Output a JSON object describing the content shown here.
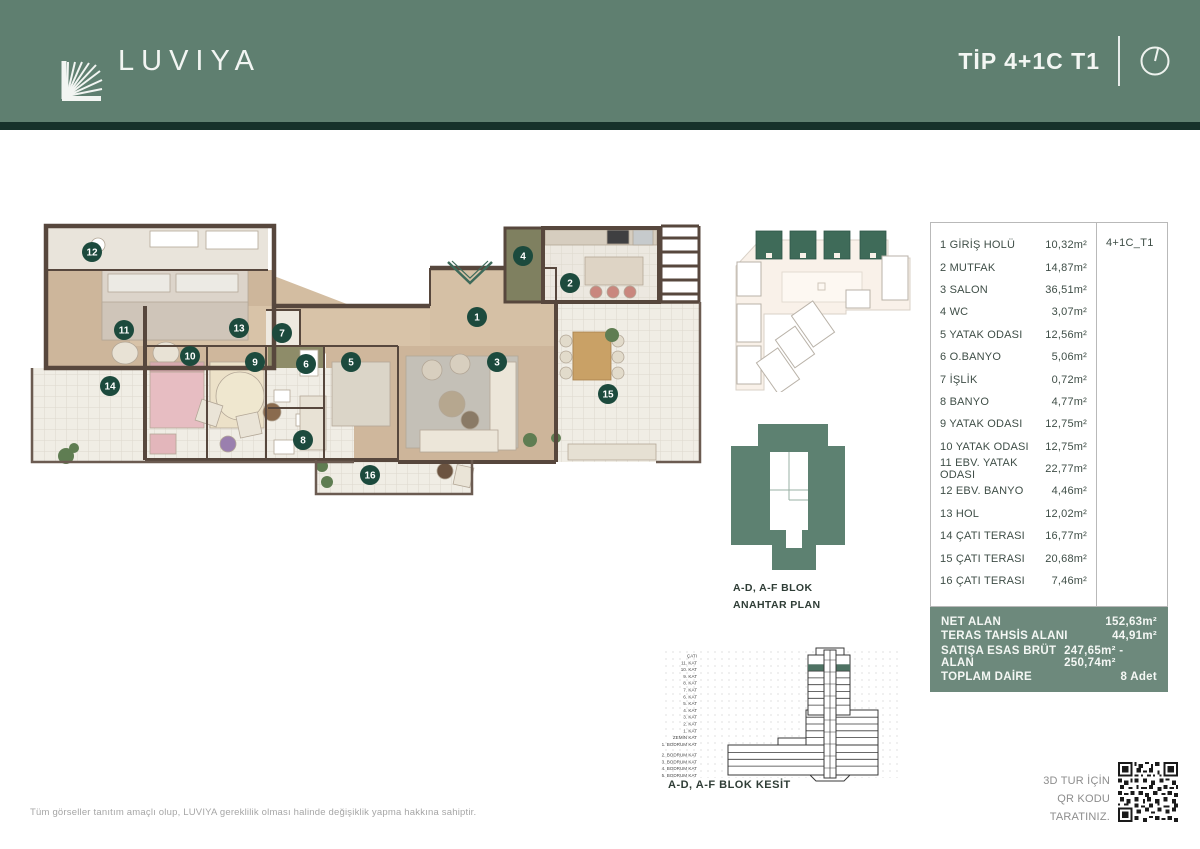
{
  "header": {
    "brand": "LUVIYA",
    "title": "TİP 4+1C T1",
    "compass_icon": "north-indicator-icon"
  },
  "floorplan": {
    "markers": [
      "1",
      "2",
      "3",
      "4",
      "5",
      "6",
      "7",
      "8",
      "9",
      "10",
      "11",
      "12",
      "13",
      "14",
      "15",
      "16"
    ],
    "entrance_arrow": "chevron-down"
  },
  "key_plan": {
    "line1": "A-D, A-F BLOK",
    "line2": "ANAHTAR PLAN"
  },
  "section": {
    "caption": "A-D, A-F BLOK KESİT",
    "highlighted_floor": "10. KAT",
    "floors": [
      "ÇATI",
      "11. KAT",
      "10. KAT",
      "9. KAT",
      "8. KAT",
      "7. KAT",
      "6. KAT",
      "5. KAT",
      "4. KAT",
      "3. KAT",
      "2. KAT",
      "1. KAT",
      "ZEMİN KAT",
      "1. BODRUM KAT",
      "2. BODRUM KAT",
      "3. BODRUM KAT",
      "4. BODRUM KAT",
      "5. BODRUM KAT"
    ]
  },
  "table": {
    "unit_code": "4+1C_T1",
    "rooms": [
      {
        "label": "1 GİRİŞ HOLÜ",
        "area": "10,32m²"
      },
      {
        "label": "2 MUTFAK",
        "area": "14,87m²"
      },
      {
        "label": "3 SALON",
        "area": "36,51m²"
      },
      {
        "label": "4 WC",
        "area": "3,07m²"
      },
      {
        "label": "5 YATAK ODASI",
        "area": "12,56m²"
      },
      {
        "label": "6 O.BANYO",
        "area": "5,06m²"
      },
      {
        "label": "7 İŞLİK",
        "area": "0,72m²"
      },
      {
        "label": "8 BANYO",
        "area": "4,77m²"
      },
      {
        "label": "9 YATAK ODASI",
        "area": "12,75m²"
      },
      {
        "label": "10 YATAK ODASI",
        "area": "12,75m²"
      },
      {
        "label": "11 EBV. YATAK ODASI",
        "area": "22,77m²"
      },
      {
        "label": "12 EBV. BANYO",
        "area": "4,46m²"
      },
      {
        "label": "13 HOL",
        "area": "12,02m²"
      },
      {
        "label": "14 ÇATI TERASI",
        "area": "16,77m²"
      },
      {
        "label": "15 ÇATI TERASI",
        "area": "20,68m²"
      },
      {
        "label": "16 ÇATI TERASI",
        "area": "7,46m²"
      }
    ]
  },
  "summary": {
    "rows": [
      {
        "label": "NET ALAN",
        "value": "152,63m²"
      },
      {
        "label": "TERAS TAHSİS ALANI",
        "value": "44,91m²"
      },
      {
        "label": "SATIŞA ESAS BRÜT ALAN",
        "value": "247,65m² - 250,74m²"
      },
      {
        "label": "TOPLAM DAİRE",
        "value": "8 Adet"
      }
    ]
  },
  "qr": {
    "line1": "3D TUR İÇİN",
    "line2": "QR KODU TARATINIZ."
  },
  "footer": {
    "disclaimer": "Tüm görseller tanıtım amaçlı olup, LUVIYA gereklilik olması halinde değişiklik yapma hakkına sahiptir."
  },
  "colors": {
    "header_green": "#5f7f70",
    "dark_strip": "#16312a",
    "marker_green": "#1c4a3d",
    "summary_green": "#6d897c",
    "key_plan_green": "#5d8171",
    "site_block_green": "#3f6b59",
    "wall_brown": "#57473d",
    "wood_floor": "#cfb79c"
  }
}
